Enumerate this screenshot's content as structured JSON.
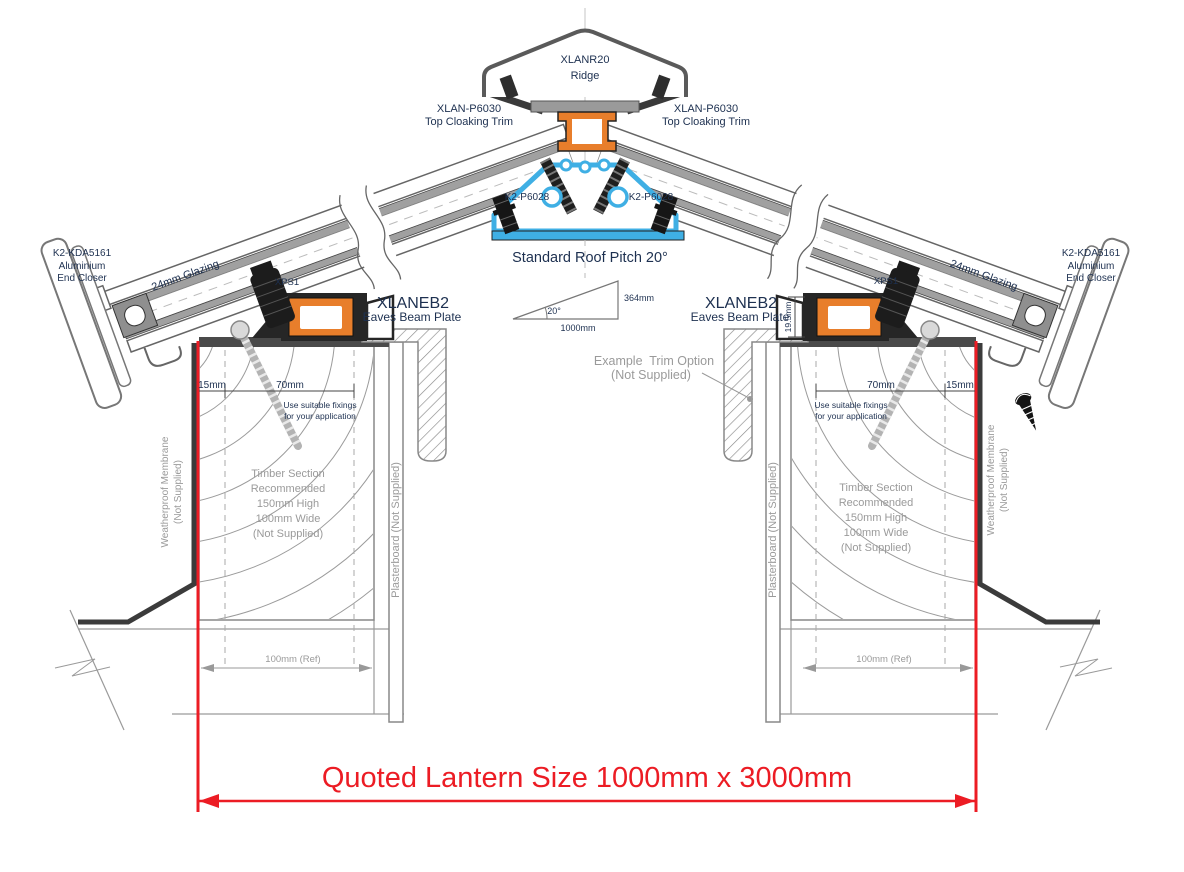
{
  "drawing_labels": {
    "ridge_part": "XLANR20",
    "ridge_name": "Ridge",
    "cloaking_part": "XLAN-P6030",
    "cloaking_name": "Top Cloaking Trim",
    "ridge_fixing_part": "K2-P6028",
    "pitch_note": "Standard Roof Pitch 20°",
    "pitch_angle": "20°",
    "pitch_base": "1000mm",
    "pitch_rise": "364mm",
    "end_closer_part": "K2-KDA5161",
    "end_closer_line2": "Aluminium",
    "end_closer_line3": "End Closer",
    "glazing": "24mm Glazing",
    "spacer": "XPS1",
    "eaves_part": "XLANEB2",
    "eaves_name": "Eaves Beam Plate",
    "dim_edge": "15mm",
    "dim_fixing_zone": "70mm",
    "dim_beam_height": "19.5mm",
    "dim_kerb_ref": "100mm (Ref)",
    "fixings_line1": "Use suitable fixings",
    "fixings_line2": "for your application",
    "timber_line1": "Timber Section",
    "timber_line2": "Recommended",
    "timber_line3": "150mm High",
    "timber_line4": "100mm Wide",
    "timber_line5": "(Not Supplied)",
    "plasterboard": "Plasterboard (Not Supplied)",
    "membrane_line1": "Weatherproof Membrane",
    "membrane_line2": "(Not Supplied)",
    "trim_option_line1": "Example  Trim Option",
    "trim_option_line2": "(Not Supplied)",
    "quoted_size": "Quoted Lantern Size 1000mm x 3000mm"
  },
  "colors": {
    "accent_red": "#EC1C24",
    "profile_orange": "#E87E2B",
    "profile_blue": "#3FAFE4",
    "label_navy": "#1d3050",
    "annotation_gray": "#9a9a9a",
    "profile_dark": "#262626"
  }
}
